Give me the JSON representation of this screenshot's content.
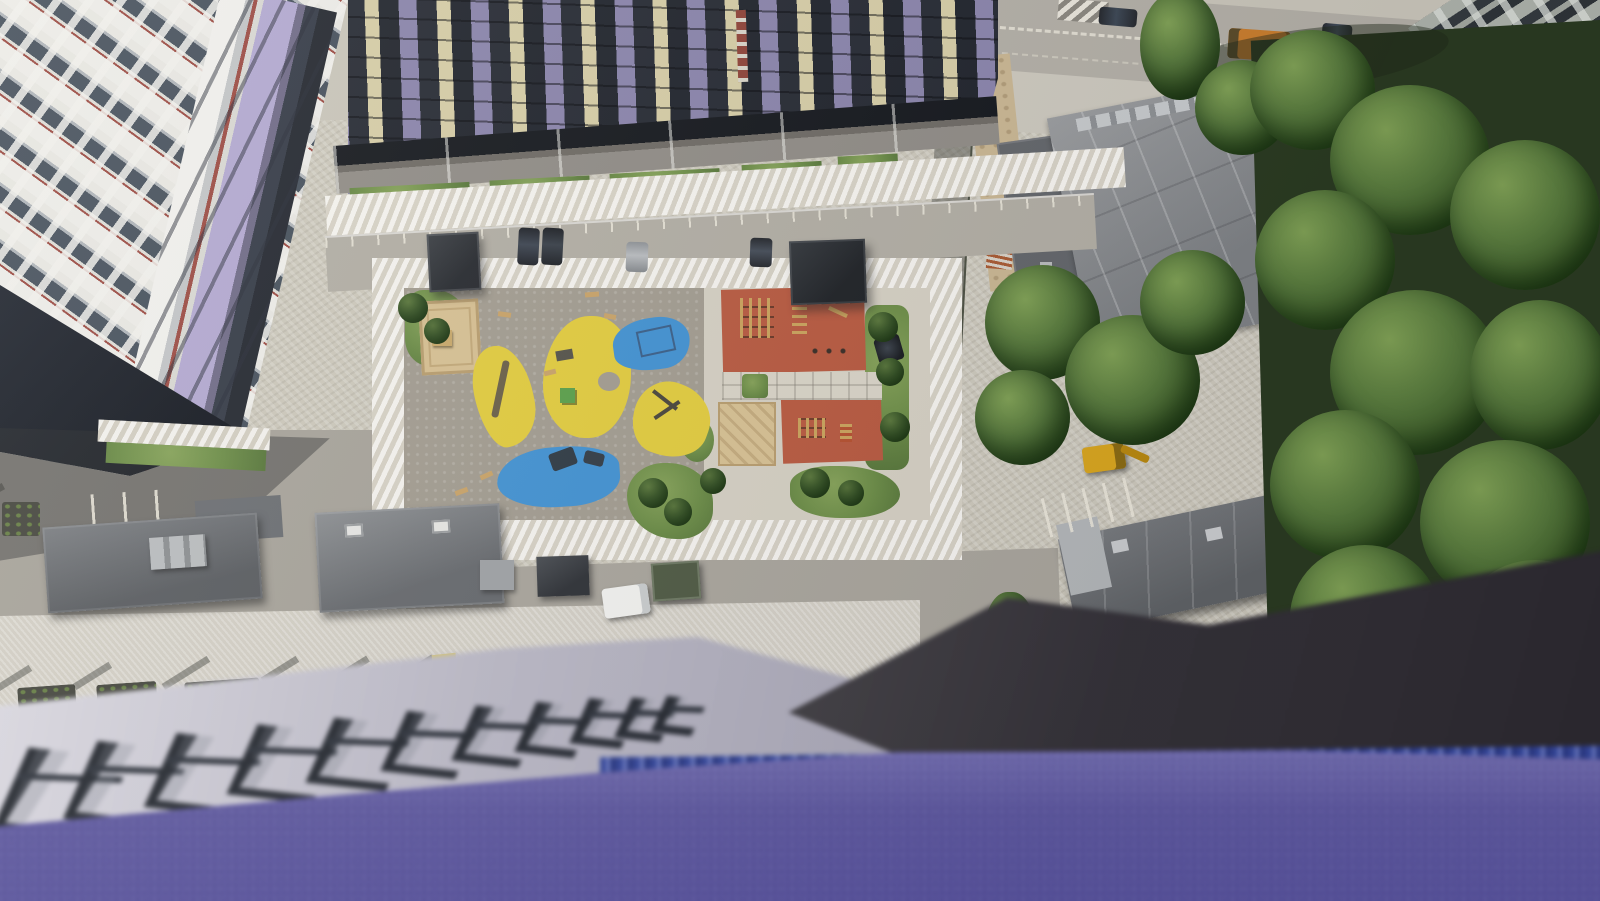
{
  "scene": {
    "type": "photograph",
    "description": "Aerial view straight down from a high-rise balcony over a new residential courtyard: colorful playgrounds (yellow and blue rubber surfacing), two red sport courts, sand pits, lawns, paved walkways, parking with cars, flat-roofed service buildings, a street with moving traffic at the top, dense green trees on the right, and a blurred violet balcony parapet with dark railing brackets filling the foreground.",
    "lighting": "bright midday sun with hard shadows",
    "no_visible_text": true
  },
  "palette": {
    "purple_parapet": "#645ea6",
    "parapet_blue_edge": "#3a4f9e",
    "shadow_wedge": "#343338",
    "ledge_gray": "#c7c4cf",
    "bracket_dark": "#262a31",
    "paving_light": "#ccc8bb",
    "walkway_white": "#e2ddd0",
    "asphalt": "#aaa69d",
    "rubber_yellow": "#e2cc3e",
    "rubber_blue": "#4292d2",
    "court_red": "#b85a40",
    "sand_tan": "#d7c193",
    "grass_green": "#6b8c46",
    "tree_green": "#3f5e2c",
    "roof_gray": "#717477",
    "roof_light": "#9b9ea0",
    "facade_white": "#ecebe7",
    "facade_dark": "#262a33",
    "panel_lavender": "#b2a8d0",
    "awning_purple": "#8a84ab",
    "pillar_cream": "#d6cda6",
    "accent_red_brown": "#9b4a42",
    "old_building_gray": "#9ba09a",
    "truck_orange": "#c87c2c",
    "excavator_yellow": "#d8a51e",
    "van_white": "#f1f1ee",
    "dumpster_green": "#4f5a43",
    "car_dark": "#24272c",
    "car_gray": "#8e9296",
    "marking_white": "#eeeadd",
    "dirt_tan": "#c9b692",
    "rust_orange": "#a85a32"
  },
  "objects": {
    "buildings": [
      "left-residential-tower",
      "middle-residential-tower",
      "old-apartment-block",
      "market-flat-roof",
      "garage-annex",
      "service-building-l-shaped",
      "service-building-center",
      "service-building-right"
    ],
    "playground": [
      "yellow-rubber-pads",
      "blue-rubber-pads",
      "red-sport-courts",
      "sand-pits",
      "lawn-patches",
      "benches",
      "climbing-frames",
      "pergola-shelters"
    ],
    "vehicles": [
      "dump-truck",
      "street-cars",
      "suv",
      "parked-cars",
      "white-van",
      "yellow-excavator",
      "green-dumpster"
    ],
    "foreground": [
      "violet-parapet",
      "railing-brackets",
      "concrete-ledge",
      "shadowed-wall-edge"
    ],
    "vegetation": [
      "tree-canopies",
      "courtyard-saplings",
      "planter-strips"
    ]
  }
}
